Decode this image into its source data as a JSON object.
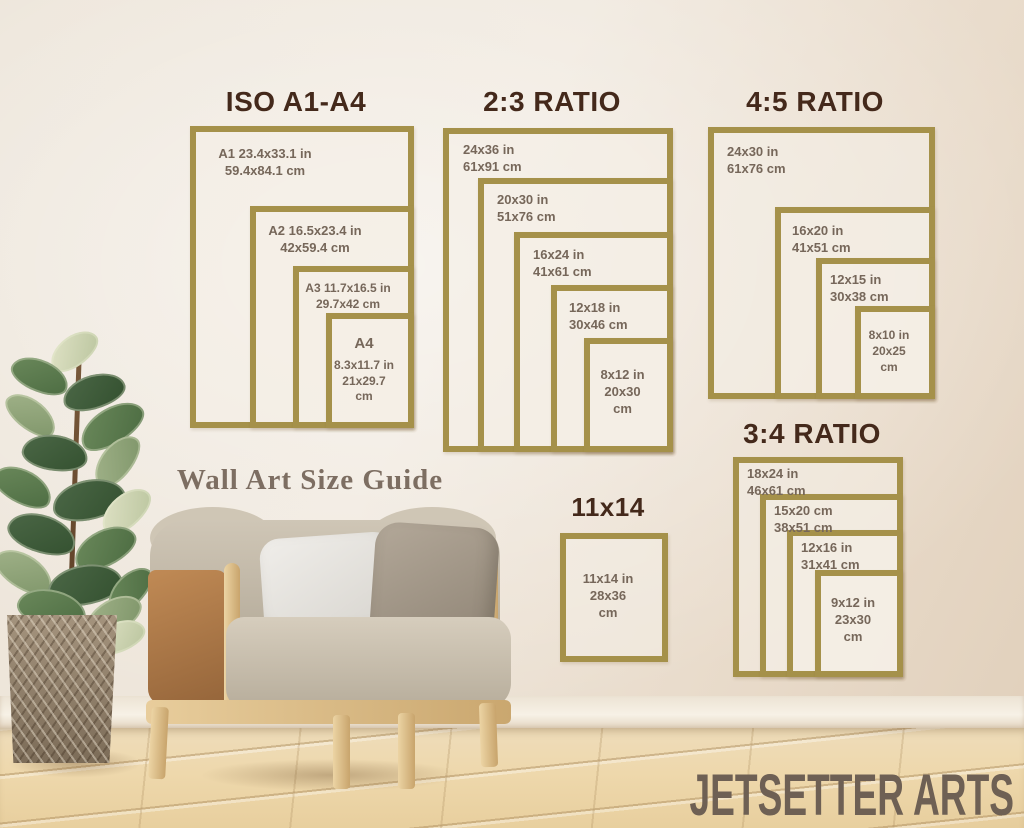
{
  "heading": {
    "text": "Wall Art Size Guide"
  },
  "brand": {
    "text": "JETSETTER ARTS"
  },
  "colors": {
    "frame_gold": "#a5914a",
    "title_brown": "#44291b",
    "label_brown": "#76675a",
    "heading_brown": "#7d6e62",
    "brand_brown": "#6e6054"
  },
  "groups": {
    "iso": {
      "title": "ISO A1-A4",
      "boxes": [
        {
          "lines": [
            "A1 23.4x33.1 in",
            "59.4x84.1 cm"
          ]
        },
        {
          "lines": [
            "A2 16.5x23.4 in",
            "42x59.4 cm"
          ]
        },
        {
          "lines": [
            "A3 11.7x16.5 in",
            "29.7x42 cm"
          ]
        },
        {
          "lines": [
            "A4",
            "8.3x11.7 in",
            "21x29.7",
            "cm"
          ]
        }
      ]
    },
    "r23": {
      "title": "2:3 RATIO",
      "boxes": [
        {
          "lines": [
            "24x36 in",
            "61x91 cm"
          ]
        },
        {
          "lines": [
            "20x30 in",
            "51x76 cm"
          ]
        },
        {
          "lines": [
            "16x24 in",
            "41x61 cm"
          ]
        },
        {
          "lines": [
            "12x18 in",
            "30x46 cm"
          ]
        },
        {
          "lines": [
            "8x12 in",
            "20x30",
            "cm"
          ]
        }
      ]
    },
    "r45": {
      "title": "4:5 RATIO",
      "boxes": [
        {
          "lines": [
            "24x30 in",
            "61x76 cm"
          ]
        },
        {
          "lines": [
            "16x20 in",
            "41x51 cm"
          ]
        },
        {
          "lines": [
            "12x15 in",
            "30x38 cm"
          ]
        },
        {
          "lines": [
            "8x10 in",
            "20x25",
            "cm"
          ]
        }
      ]
    },
    "r34": {
      "title": "3:4 RATIO",
      "boxes": [
        {
          "lines": [
            "18x24 in",
            "46x61 cm"
          ]
        },
        {
          "lines": [
            "15x20 cm",
            "38x51 cm"
          ]
        },
        {
          "lines": [
            "12x16 in",
            "31x41 cm"
          ]
        },
        {
          "lines": [
            "9x12 in",
            "23x30",
            "cm"
          ]
        }
      ]
    },
    "s11x14": {
      "title": "11x14",
      "boxes": [
        {
          "lines": [
            "11x14 in",
            "28x36",
            "cm"
          ]
        }
      ]
    }
  }
}
